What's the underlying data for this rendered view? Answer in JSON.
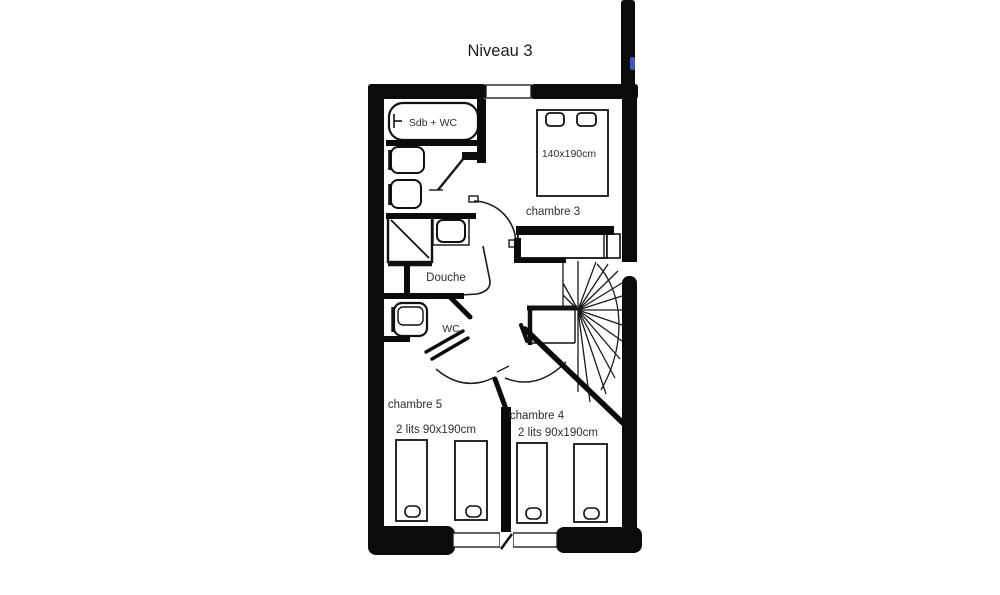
{
  "title": "Niveau 3",
  "plan": {
    "rooms": {
      "bathroom_top": {
        "label": "Sdb + WC"
      },
      "shower_room": {
        "label": "Douche"
      },
      "wc_room": {
        "label": "WC"
      },
      "bedroom3": {
        "label": "chambre 3",
        "bed_size": "140x190cm"
      },
      "bedroom4": {
        "label": "chambre 4",
        "beds": "2 lits 90x190cm"
      },
      "bedroom5": {
        "label": "chambre 5",
        "beds": "2 lits 90x190cm"
      }
    },
    "features": {
      "staircase": "winder-staircase",
      "windows": "bottom-wall-windows",
      "marker": "blue-wall-marker"
    }
  },
  "colors": {
    "wall": "#0b0b0b",
    "line": "#1a1a1a",
    "text": "#2e2e2e",
    "accent_blue": "#4453c0",
    "background": "#ffffff"
  }
}
